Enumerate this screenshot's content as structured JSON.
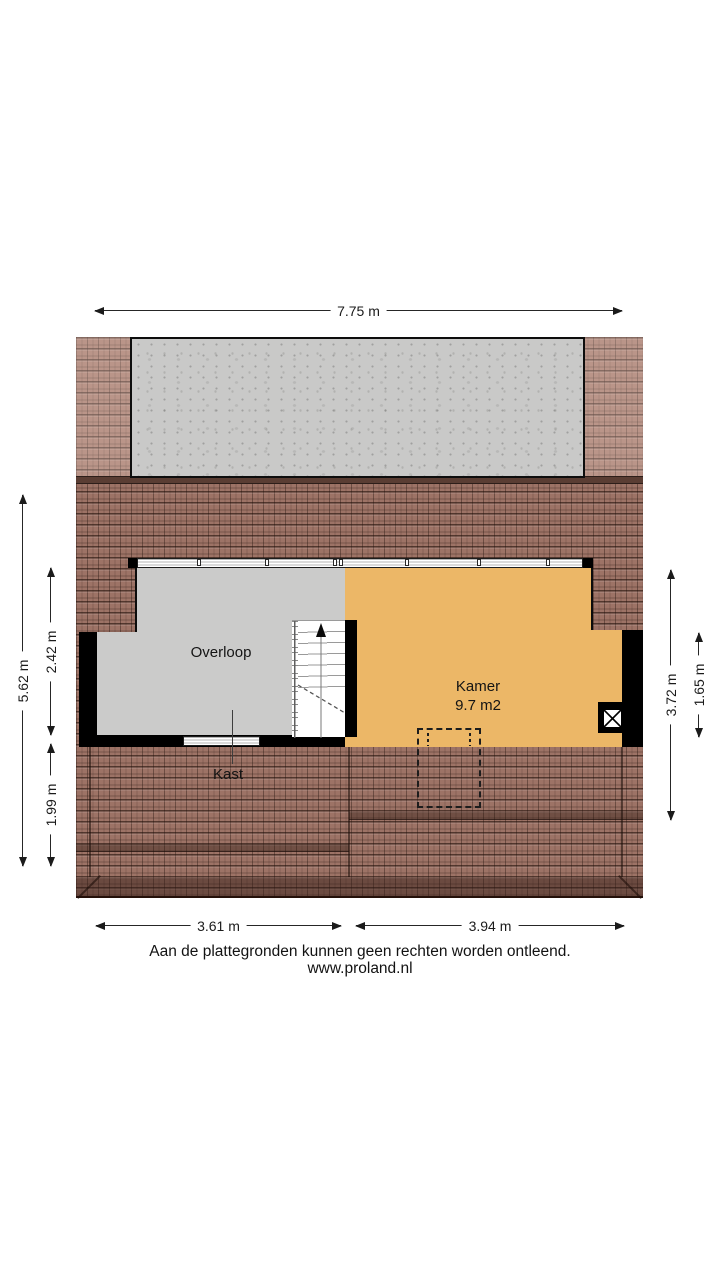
{
  "plan": {
    "rooms": {
      "overloop": {
        "label": "Overloop"
      },
      "kamer": {
        "label": "Kamer",
        "area": "9.7 m2"
      },
      "kast": {
        "label": "Kast"
      }
    },
    "icons": {
      "stairs_direction": "up-arrow",
      "shaft": "x-cross-shaft",
      "roof_window": "dashed-outline"
    }
  },
  "dimensions": {
    "top": [
      {
        "label": "7.75 m"
      }
    ],
    "left": [
      {
        "label": "5.62 m"
      },
      {
        "label": "2.42 m"
      },
      {
        "label": "1.99 m"
      }
    ],
    "right": [
      {
        "label": "3.72 m"
      },
      {
        "label": "1.65 m"
      }
    ],
    "bottom": [
      {
        "label": "3.61 m"
      },
      {
        "label": "3.94 m"
      }
    ]
  },
  "footer": {
    "disclaimer": "Aan de plattegronden kunnen geen rechten worden ontleend.",
    "website": "www.proland.nl"
  },
  "colors": {
    "roof_main": "#9d7366",
    "roof_upper": "#b18b7f",
    "roof_ridge": "#5a3d33",
    "roof_eave": "#6f4c41",
    "dormer_concrete": "#c9c9c8",
    "floor_overloop": "#cbcbca",
    "floor_kamer": "#ecb767",
    "wall": "#000000",
    "dimension_text": "#1b1b1b"
  }
}
